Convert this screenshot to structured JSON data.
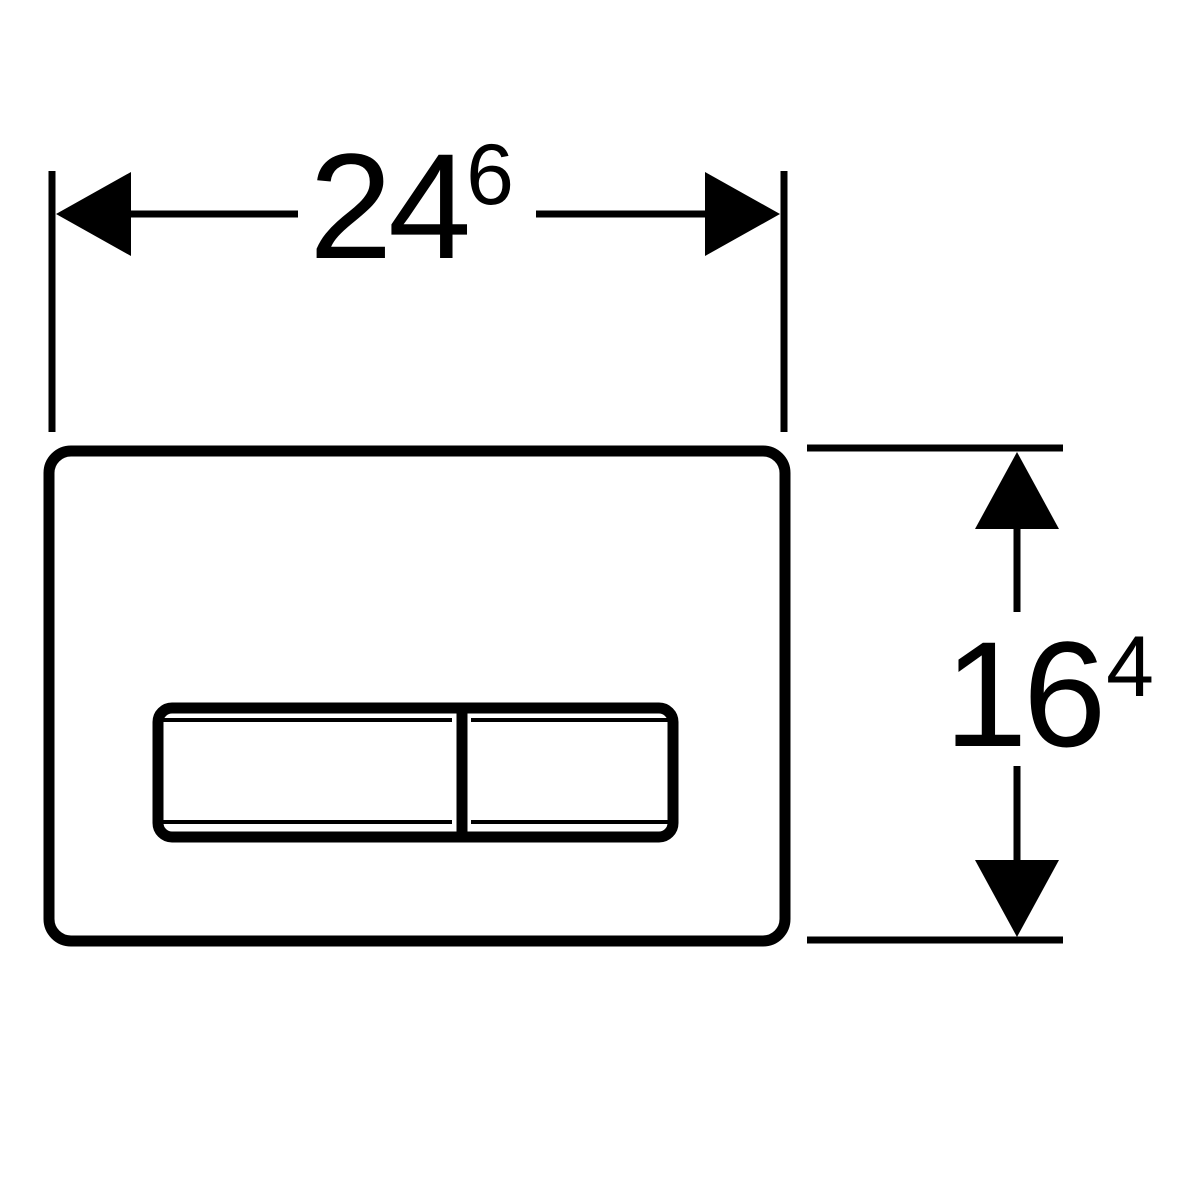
{
  "colors": {
    "line": "#000000",
    "background": "#ffffff"
  },
  "dimensions": {
    "width": {
      "main": "24",
      "superscript": "6"
    },
    "height": {
      "main": "16",
      "superscript": "4"
    }
  }
}
